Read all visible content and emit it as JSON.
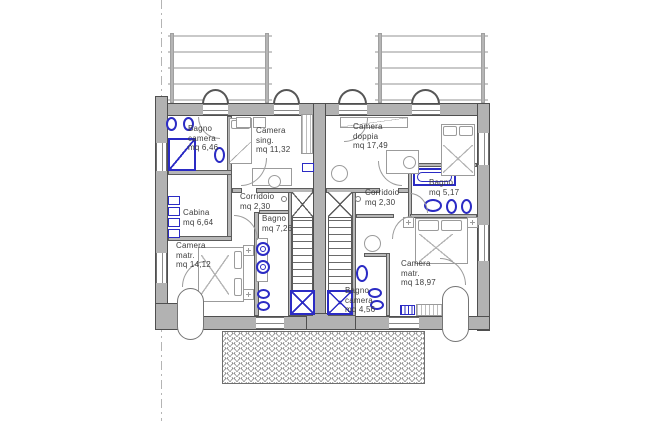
{
  "drawing": {
    "kind": "residential-floor-plan",
    "language": "Italian",
    "area_unit": "mq",
    "rooms": [
      {
        "id": "bagno-camera-left",
        "lines": [
          "Bagno",
          "camera",
          "mq 6,46"
        ]
      },
      {
        "id": "camera-singola",
        "lines": [
          "Camera",
          "sing.",
          "mq 11,32"
        ]
      },
      {
        "id": "camera-doppia",
        "lines": [
          "Camera",
          "doppia",
          "mq 17,49"
        ]
      },
      {
        "id": "corridoio-left",
        "lines": [
          "Corridoio",
          "mq 2,30"
        ]
      },
      {
        "id": "corridoio-right",
        "lines": [
          "Corridoio",
          "mq 2,30"
        ]
      },
      {
        "id": "cabina",
        "lines": [
          "Cabina",
          "mq 6,64"
        ]
      },
      {
        "id": "bagno-left",
        "lines": [
          "Bagno",
          "mq 7,26"
        ]
      },
      {
        "id": "bagno-right",
        "lines": [
          "Bagno",
          "mq 5,17"
        ]
      },
      {
        "id": "camera-matr-left",
        "lines": [
          "Camera",
          "matr.",
          "mq 14,12"
        ]
      },
      {
        "id": "camera-matr-right",
        "lines": [
          "Camera",
          "matr.",
          "mq 18,97"
        ]
      },
      {
        "id": "bagno-camera-right",
        "lines": [
          "Bagno",
          "camera",
          "mq 4,56"
        ]
      }
    ],
    "colors": {
      "wall": "#b2b2b2",
      "wall_outline": "#4f4f4f",
      "fixture_blue": "#2b2bc4",
      "furniture_gray": "#9b9b9b",
      "railing_gray": "#c9c9c9",
      "label_text": "#3d3d3d"
    }
  }
}
